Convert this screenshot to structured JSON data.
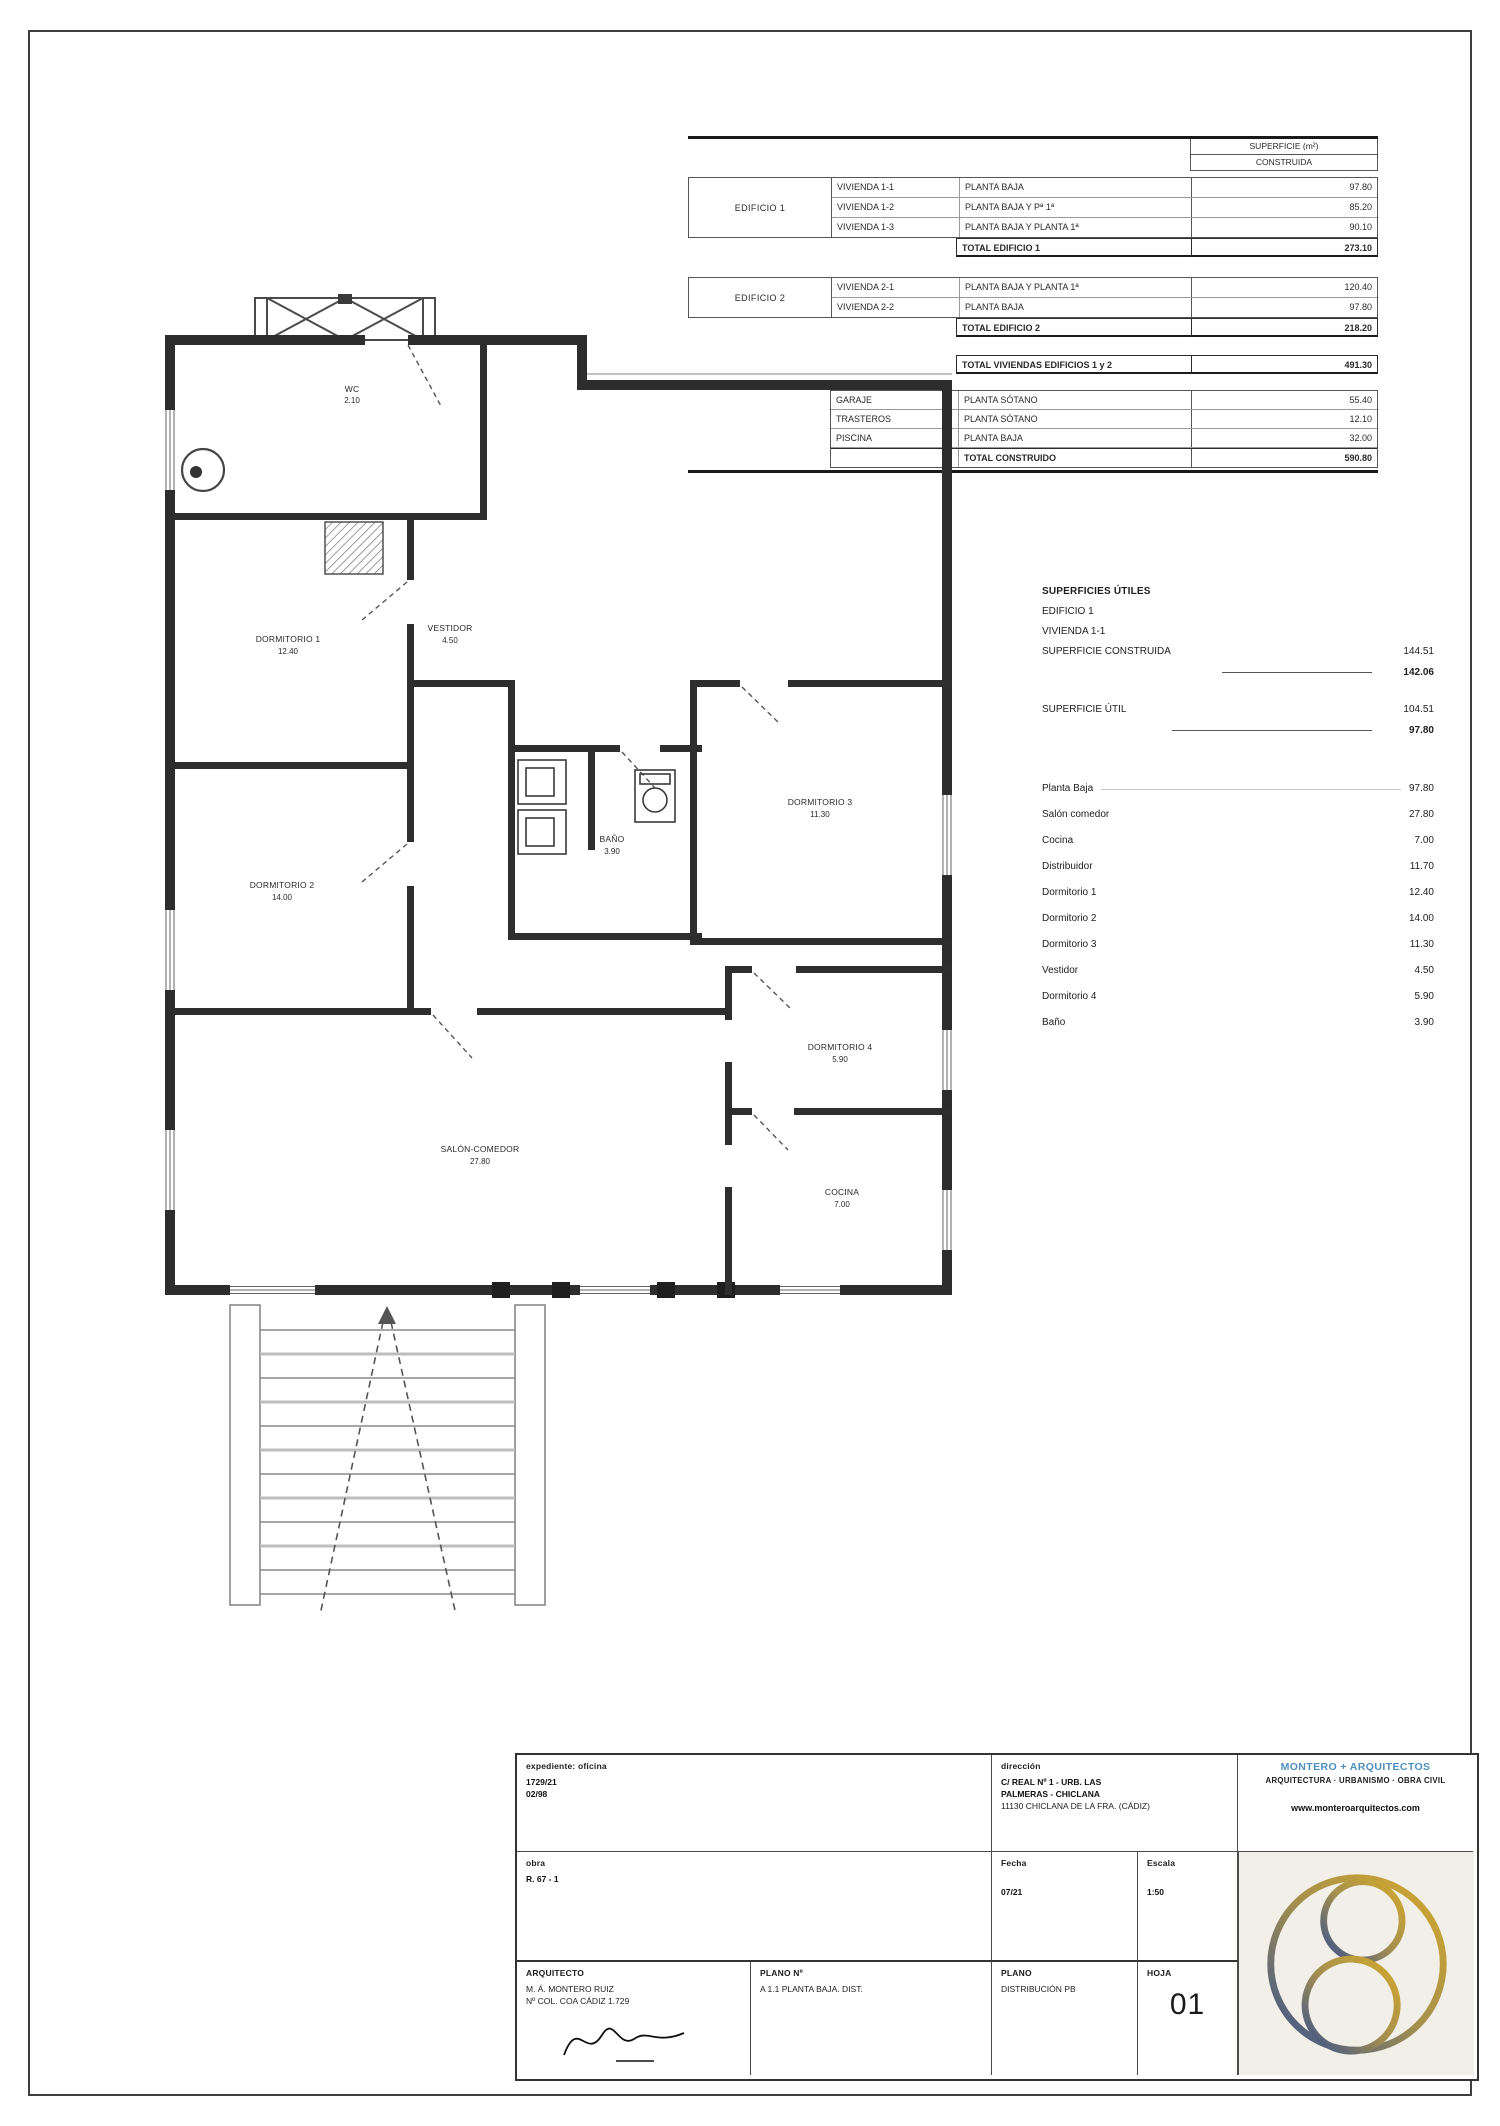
{
  "area_table": {
    "header_line1": "SUPERFICIE (m²)",
    "header_line2": "CONSTRUIDA",
    "b1_name": "EDIFICIO 1",
    "b1_rows": [
      {
        "viv": "VIVIENDA 1-1",
        "desc": "PLANTA BAJA",
        "val": "97.80"
      },
      {
        "viv": "VIVIENDA 1-2",
        "desc": "PLANTA BAJA Y Pª 1ª",
        "val": "85.20"
      },
      {
        "viv": "VIVIENDA 1-3",
        "desc": "PLANTA BAJA Y PLANTA 1ª",
        "val": "90.10"
      }
    ],
    "b1_total_label": "TOTAL EDIFICIO 1",
    "b1_total_val": "273.10",
    "b2_name": "EDIFICIO 2",
    "b2_rows": [
      {
        "viv": "VIVIENDA 2-1",
        "desc": "PLANTA BAJA Y PLANTA 1ª",
        "val": "120.40"
      },
      {
        "viv": "VIVIENDA 2-2",
        "desc": "PLANTA BAJA",
        "val": "97.80"
      }
    ],
    "b2_total_label": "TOTAL EDIFICIO 2",
    "b2_total_val": "218.20",
    "grand_label": "TOTAL VIVIENDAS EDIFICIOS 1 y 2",
    "grand_val": "491.30",
    "annex_rows": [
      {
        "name": "GARAJE",
        "desc": "PLANTA SÓTANO",
        "val": "55.40"
      },
      {
        "name": "TRASTEROS",
        "desc": "PLANTA SÓTANO",
        "val": "12.10"
      },
      {
        "name": "PISCINA",
        "desc": "PLANTA BAJA",
        "val": "32.00"
      }
    ],
    "annex_total_label": "TOTAL CONSTRUIDO",
    "annex_total_val": "590.80"
  },
  "summary": {
    "title1": "SUPERFICIES ÚTILES",
    "title2": "EDIFICIO 1",
    "title3": "VIVIENDA 1-1",
    "built_label": "SUPERFICIE CONSTRUIDA",
    "built_v1": "144.51",
    "built_v2": "142.06",
    "useful_label": "SUPERFICIE ÚTIL",
    "useful_v1": "104.51",
    "useful_v2": "97.80",
    "rooms": [
      {
        "name": "Planta Baja",
        "val": "97.80"
      },
      {
        "name": "Salón comedor",
        "val": "27.80"
      },
      {
        "name": "Cocina",
        "val": "7.00"
      },
      {
        "name": "Distribuidor",
        "val": "11.70"
      },
      {
        "name": "Dormitorio 1",
        "val": "12.40"
      },
      {
        "name": "Dormitorio 2",
        "val": "14.00"
      },
      {
        "name": "Dormitorio 3",
        "val": "11.30"
      },
      {
        "name": "Vestidor",
        "val": "4.50"
      },
      {
        "name": "Dormitorio 4",
        "val": "5.90"
      },
      {
        "name": "Baño",
        "val": "3.90"
      }
    ]
  },
  "plan": {
    "labels": {
      "wc": {
        "name": "WC",
        "area": "2.10"
      },
      "vestidor": {
        "name": "VESTIDOR",
        "area": "4.50"
      },
      "bano": {
        "name": "BAÑO",
        "area": "3.90"
      },
      "dorm1": {
        "name": "DORMITORIO 1",
        "area": "12.40"
      },
      "dorm2": {
        "name": "DORMITORIO 2",
        "area": "14.00"
      },
      "dorm3": {
        "name": "DORMITORIO 3",
        "area": "11.30"
      },
      "dorm4": {
        "name": "DORMITORIO 4",
        "area": "5.90"
      },
      "cocina": {
        "name": "COCINA",
        "area": "7.00"
      },
      "salon": {
        "name": "SALÓN-COMEDOR",
        "area": "27.80"
      }
    }
  },
  "titleblock": {
    "r1c1_label": "expediente: oficina",
    "r1c1_line1": "1729/21",
    "r1c1_line2": "02/98",
    "r1c2_label": "dirección",
    "r1c2_line1": "C/ REAL Nº 1 - URB. LAS",
    "r1c2_line2": "PALMERAS - CHICLANA",
    "r1c2_line3": "11130 CHICLANA DE LA FRA. (CÁDIZ)",
    "company_name": "MONTERO + ARQUITECTOS",
    "company_sub": "ARQUITECTURA · URBANISMO · OBRA CIVIL",
    "company_web": "www.monteroarquitectos.com",
    "r2c1_label": "obra",
    "r2c1_line1": "R. 67 - 1",
    "fecha_label": "Fecha",
    "fecha_value": "07/21",
    "escala_label": "Escala",
    "escala_value": "1:50",
    "arq_label": "ARQUITECTO",
    "arq_line1": "M. Á. MONTERO RUIZ",
    "arq_line2": "Nº COL. COA CÁDIZ 1.729",
    "plano_num_label": "PLANO Nº",
    "plano_num_value": "A 1.1 PLANTA BAJA. DIST.",
    "plano_label": "PLANO",
    "plano_value": "DISTRIBUCIÓN PB",
    "hoja_label": "HOJA",
    "hoja_value": "01"
  }
}
